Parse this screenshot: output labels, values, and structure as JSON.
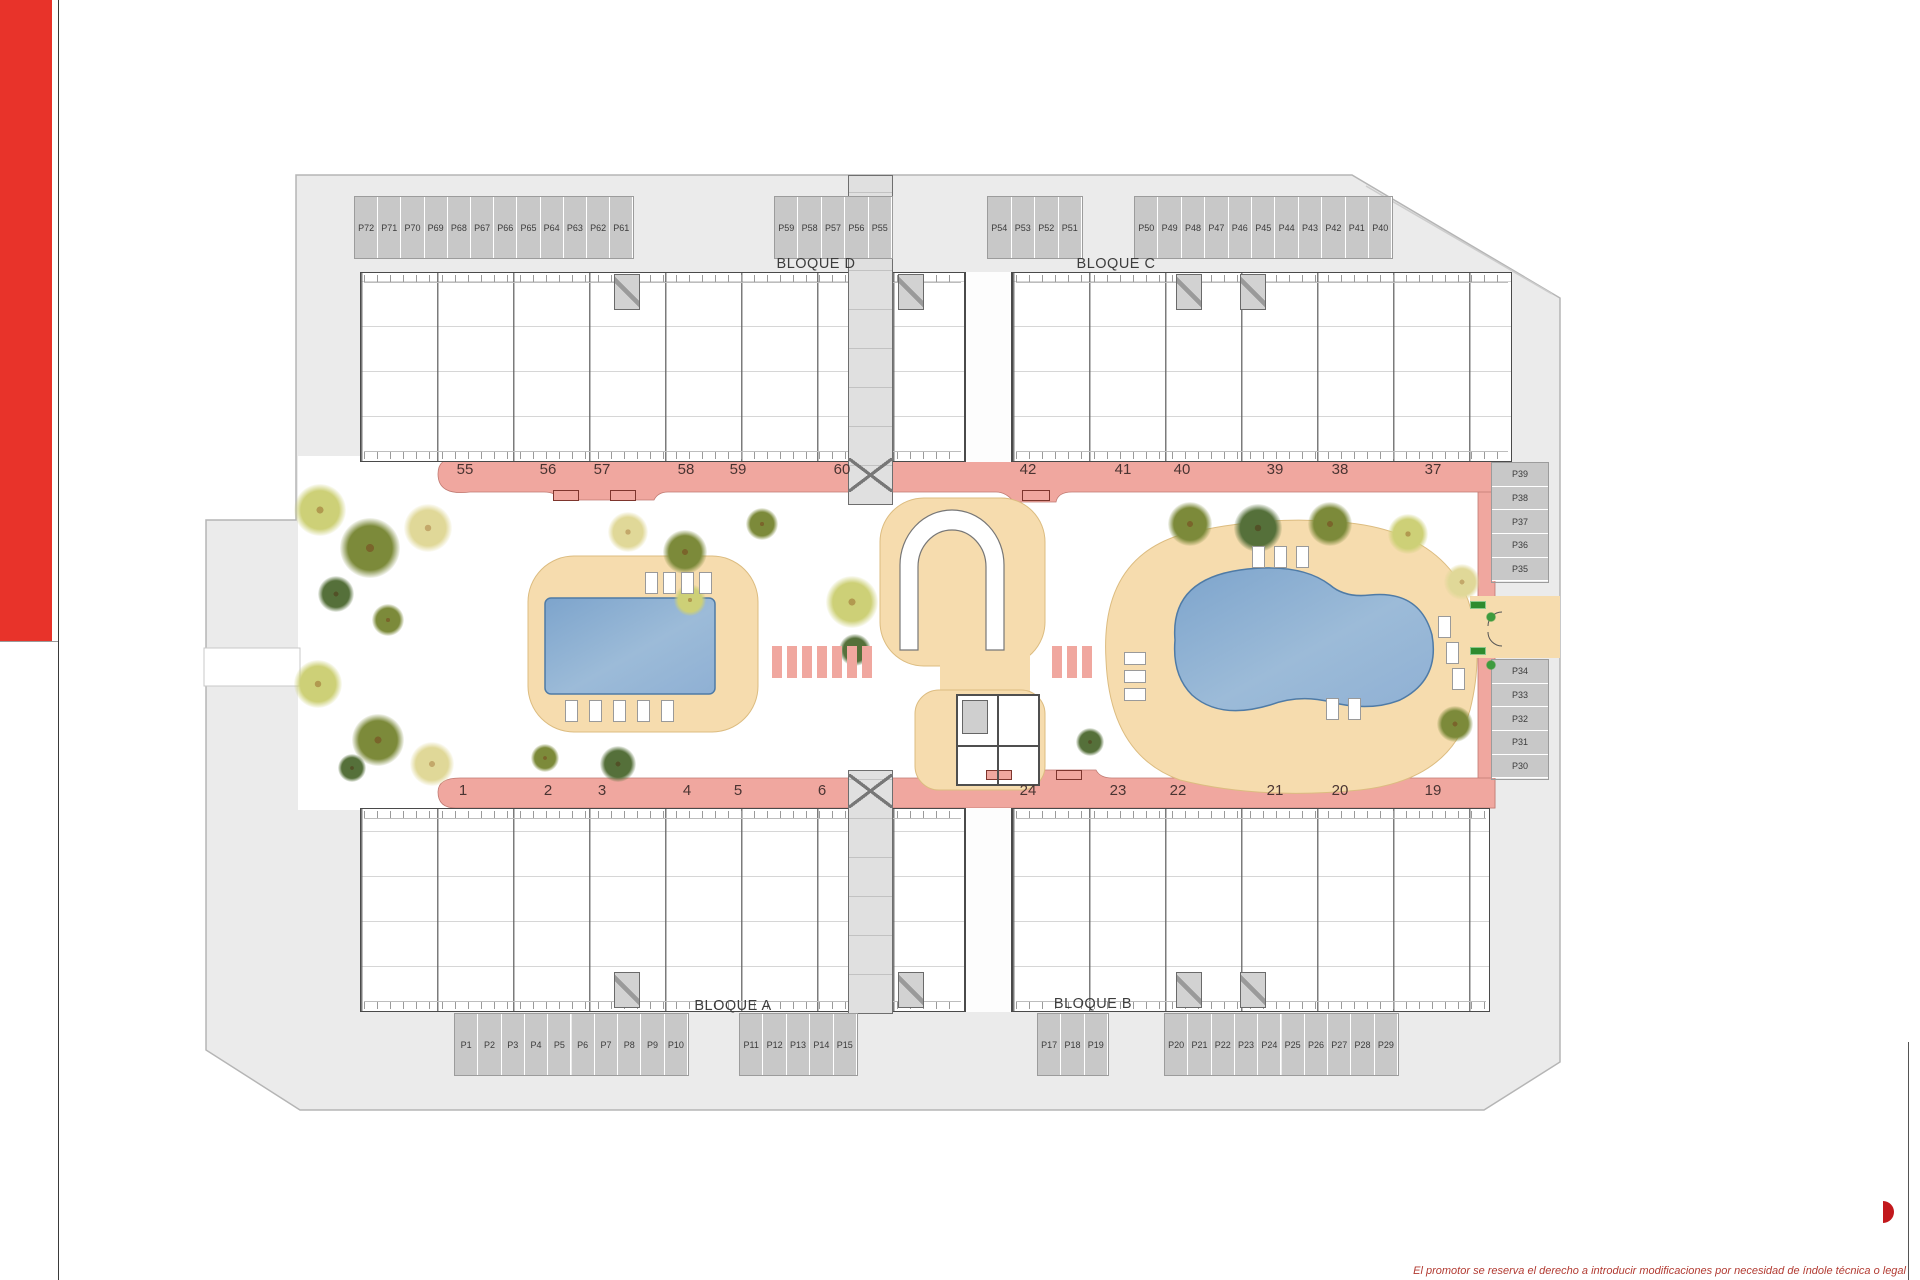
{
  "blocks": {
    "a": "BLOQUE A",
    "b": "BLOQUE B",
    "c": "BLOQUE C",
    "d": "BLOQUE D"
  },
  "parking_groups": {
    "top_left": [
      "P72",
      "P71",
      "P70",
      "P69",
      "P68",
      "P67",
      "P66",
      "P65",
      "P64",
      "P63",
      "P62",
      "P61"
    ],
    "top_left_accessible": "P60",
    "top_mid_1": [
      "P59",
      "P58",
      "P57",
      "P56",
      "P55"
    ],
    "top_mid_2": [
      "P54",
      "P53",
      "P52",
      "P51"
    ],
    "top_right": [
      "P50",
      "P49",
      "P48",
      "P47",
      "P46",
      "P45",
      "P44",
      "P43",
      "P42",
      "P41",
      "P40"
    ],
    "right_upper": [
      "P39",
      "P38",
      "P37",
      "P36",
      "P35"
    ],
    "right_lower": [
      "P34",
      "P33",
      "P32",
      "P31",
      "P30"
    ],
    "bottom_left": [
      "P1",
      "P2",
      "P3",
      "P4",
      "P5",
      "P6",
      "P7",
      "P8",
      "P9",
      "P10"
    ],
    "bottom_mid_1": [
      "P11",
      "P12",
      "P13",
      "P14",
      "P15"
    ],
    "bottom_accessible": "P16",
    "bottom_mid_2": [
      "P17",
      "P18",
      "P19"
    ],
    "bottom_right": [
      "P20",
      "P21",
      "P22",
      "P23",
      "P24",
      "P25",
      "P26",
      "P27",
      "P28",
      "P29"
    ]
  },
  "plot_numbers": {
    "top": [
      "55",
      "56",
      "57",
      "58",
      "59",
      "60",
      "42",
      "41",
      "40",
      "39",
      "38",
      "37"
    ],
    "bottom": [
      "1",
      "2",
      "3",
      "4",
      "5",
      "6",
      "24",
      "23",
      "22",
      "21",
      "20",
      "19"
    ]
  },
  "footer": {
    "disclaimer": "El promotor se reserva el derecho a introducir modificaciones por necesidad de índole técnica o legal"
  },
  "icons": {
    "accessible": "wheelchair-icon"
  },
  "colors": {
    "path_pink": "#f0a79f",
    "sand": "#f6dcae",
    "pool_blue": "#8fb0d4",
    "site_gray": "#ebebeb",
    "cell_gray": "#c8c8c8",
    "accent_red": "#e8332a"
  }
}
